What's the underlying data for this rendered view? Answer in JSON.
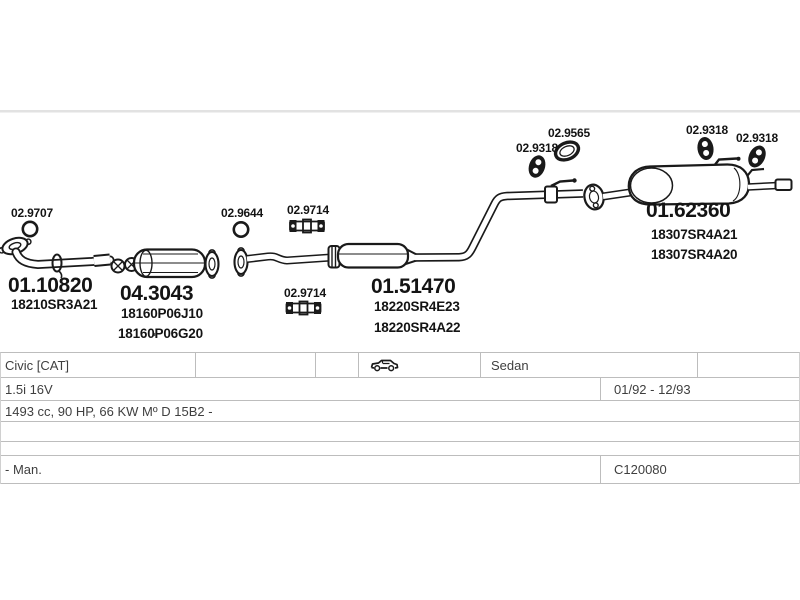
{
  "diagram": {
    "labels": {
      "p02_9707": "02.9707",
      "p02_9644": "02.9644",
      "p02_9714": "02.9714",
      "p02_9318": "02.9318",
      "p02_9565": "02.9565",
      "p01_10820": "01.10820",
      "n18210SR3A21": "18210SR3A21",
      "p04_3043": "04.3043",
      "n18160P06J10": "18160P06J10",
      "n18160P06G20": "18160P06G20",
      "p01_51470": "01.51470",
      "n18220SR4E23": "18220SR4E23",
      "n18220SR4A22": "18220SR4A22",
      "p01_62360": "01.62360",
      "n18307SR4A21": "18307SR4A21",
      "n18307SR4A20": "18307SR4A20"
    },
    "icons": {
      "o_ring": "o-ring-gasket-icon",
      "strap": "strap-bracket-icon",
      "mount": "rubber-mount-icon",
      "oval": "oval-gasket-icon",
      "car": "sedan-car-icon"
    }
  },
  "vehicle_table": {
    "model": "Civic [CAT]",
    "body_type": "Sedan",
    "engine": "1.5i 16V",
    "build_period": "01/92 - 12/93",
    "engine_spec": "1493 cc, 90 HP, 66 KW Mº D 15B2 -",
    "transmission": "- Man.",
    "catalog_code": "C120080"
  },
  "colors": {
    "line_art": "#1a1a1a",
    "table_border": "#bdbdbd",
    "table_text": "#3f3f3f",
    "page_divider": "#e2e2e2"
  }
}
